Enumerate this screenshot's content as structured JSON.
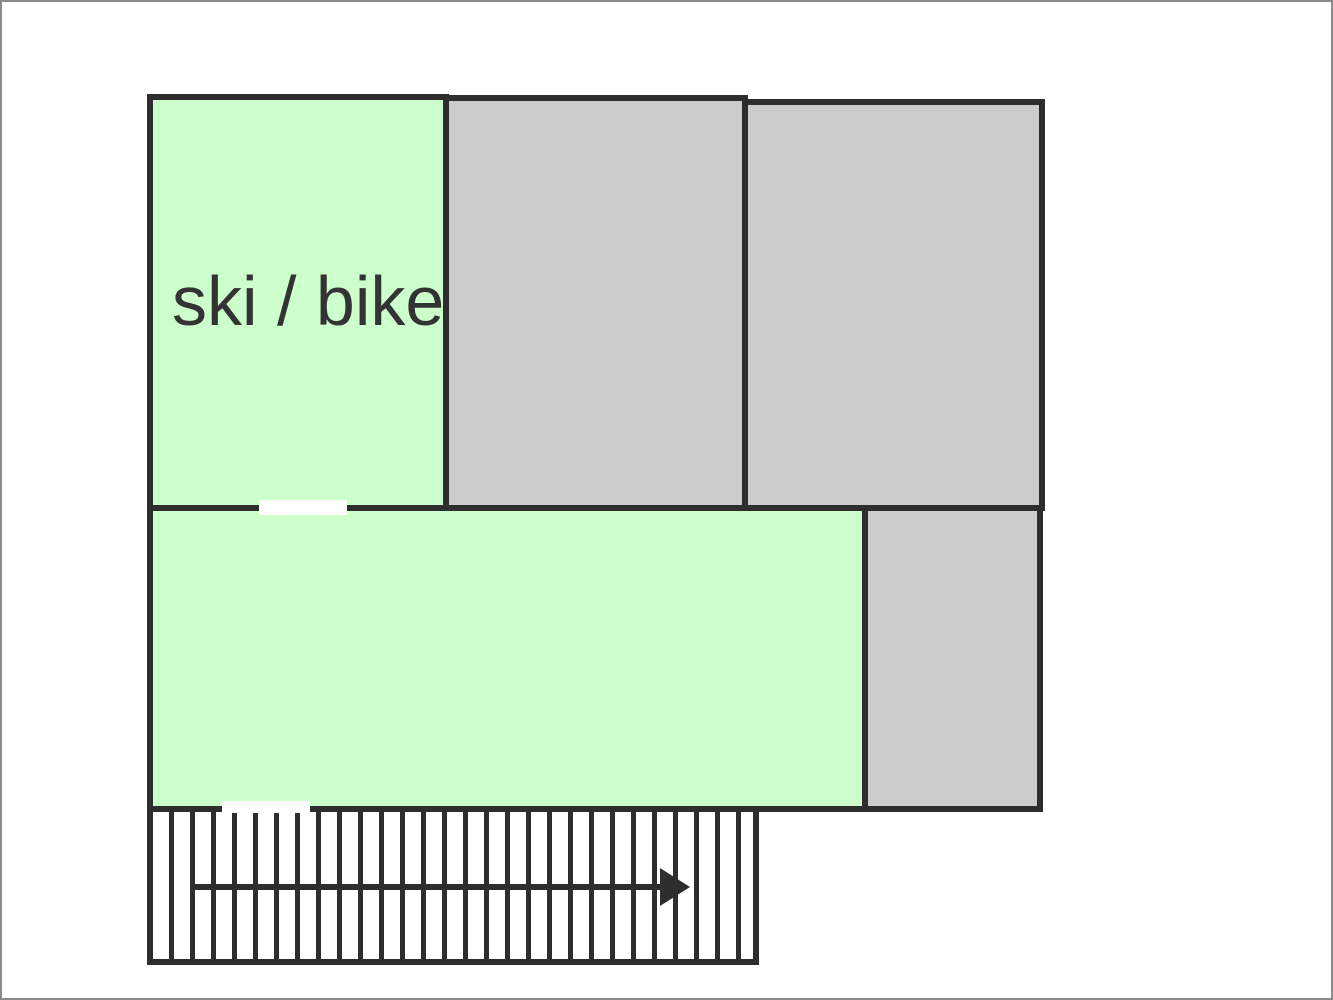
{
  "colors": {
    "wall": "#2e2e2e",
    "text": "#333333",
    "room-green": "#ccffcc",
    "room-gray": "#cccccc",
    "background": "#ffffff",
    "frame": "#8a8a8a"
  },
  "floorplan": {
    "rooms": [
      {
        "name": "ski-bike-room",
        "label": "ski / bike",
        "fill": "#ccffcc"
      },
      {
        "name": "top-middle-room",
        "label": "",
        "fill": "#cccccc"
      },
      {
        "name": "top-right-room",
        "label": "",
        "fill": "#cccccc"
      },
      {
        "name": "main-lower-room",
        "label": "",
        "fill": "#ccffcc"
      },
      {
        "name": "side-lower-room",
        "label": "",
        "fill": "#cccccc"
      }
    ],
    "doors": [
      {
        "name": "door-opening-upper"
      },
      {
        "name": "door-opening-lower"
      }
    ],
    "stairs": {
      "name": "staircase",
      "steps": 28,
      "direction": "right"
    }
  }
}
